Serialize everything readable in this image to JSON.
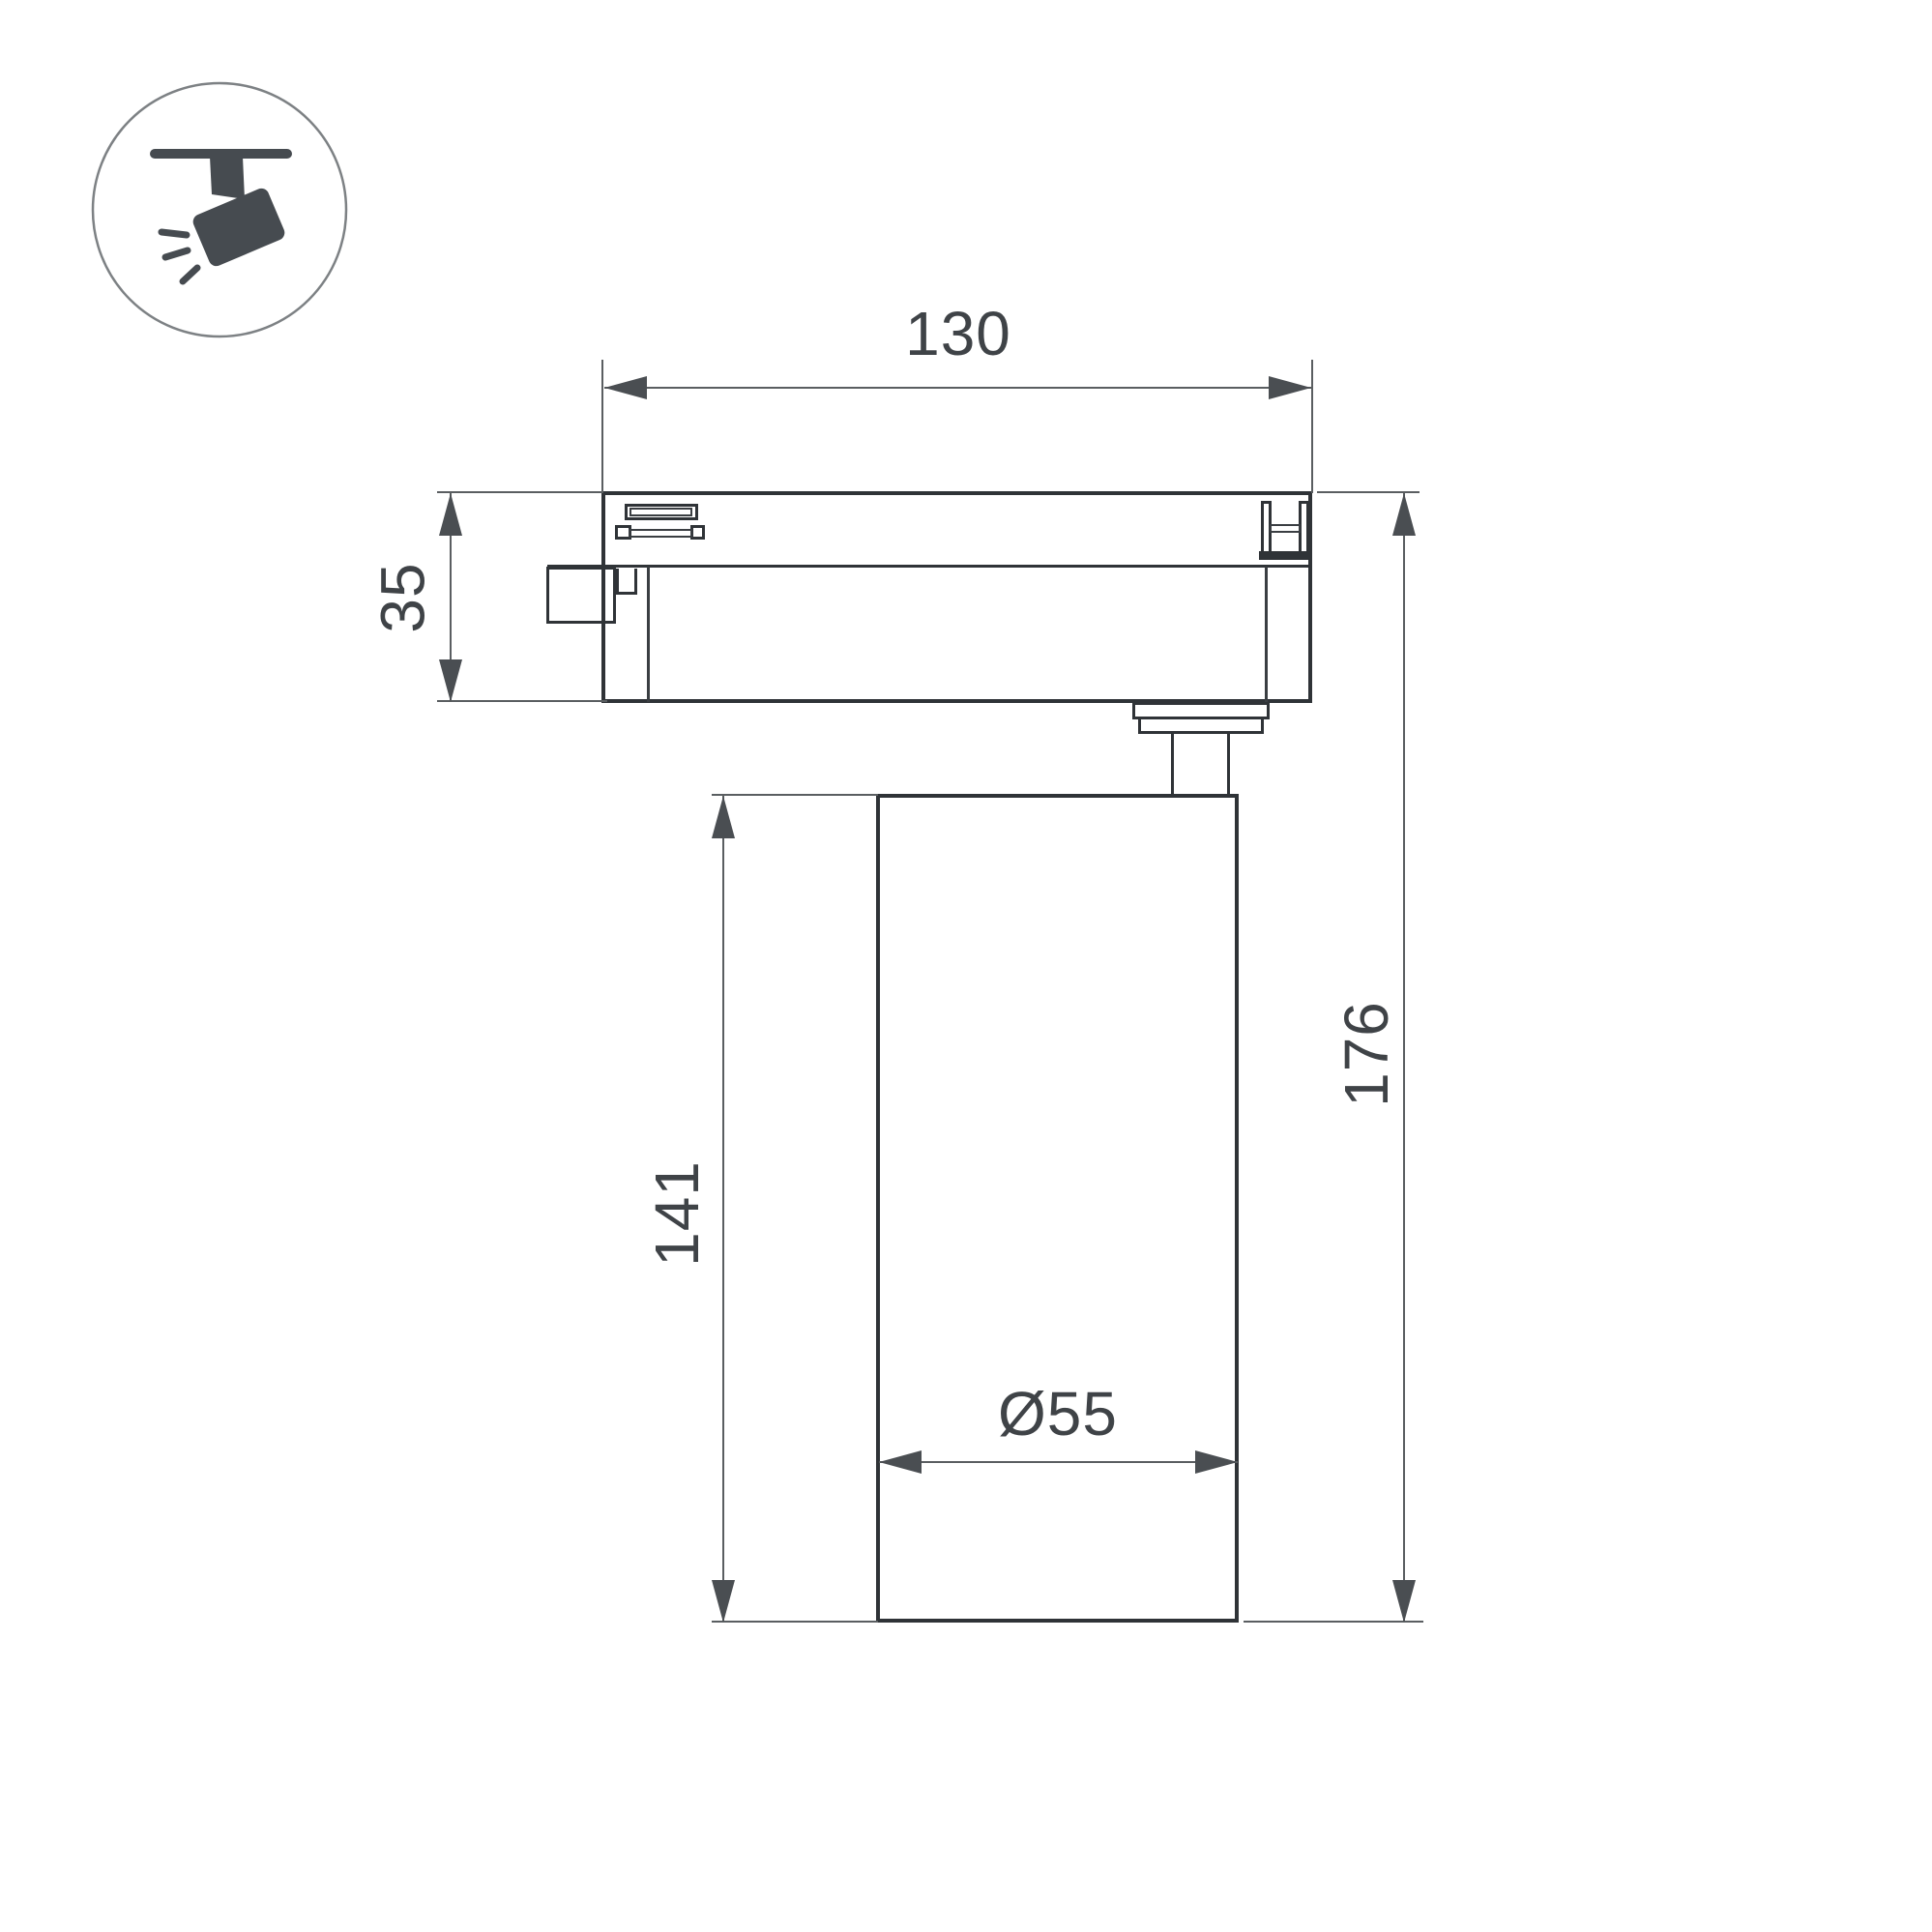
{
  "drawing": {
    "title": "track spotlight dimension drawing",
    "labels": {
      "track_width": "130",
      "adapter_height": "35",
      "body_height": "141",
      "total_height": "176",
      "body_diameter": "Ø55"
    }
  },
  "icon": {
    "name": "track-spotlight-icon",
    "description": "spotlight hanging from ceiling track, tilted, emitting light rays"
  },
  "colors": {
    "background": "#ffffff",
    "outline": "#2f3337",
    "dimension": "#5a5e61",
    "text": "#3f4347",
    "icon": "#464b50"
  }
}
